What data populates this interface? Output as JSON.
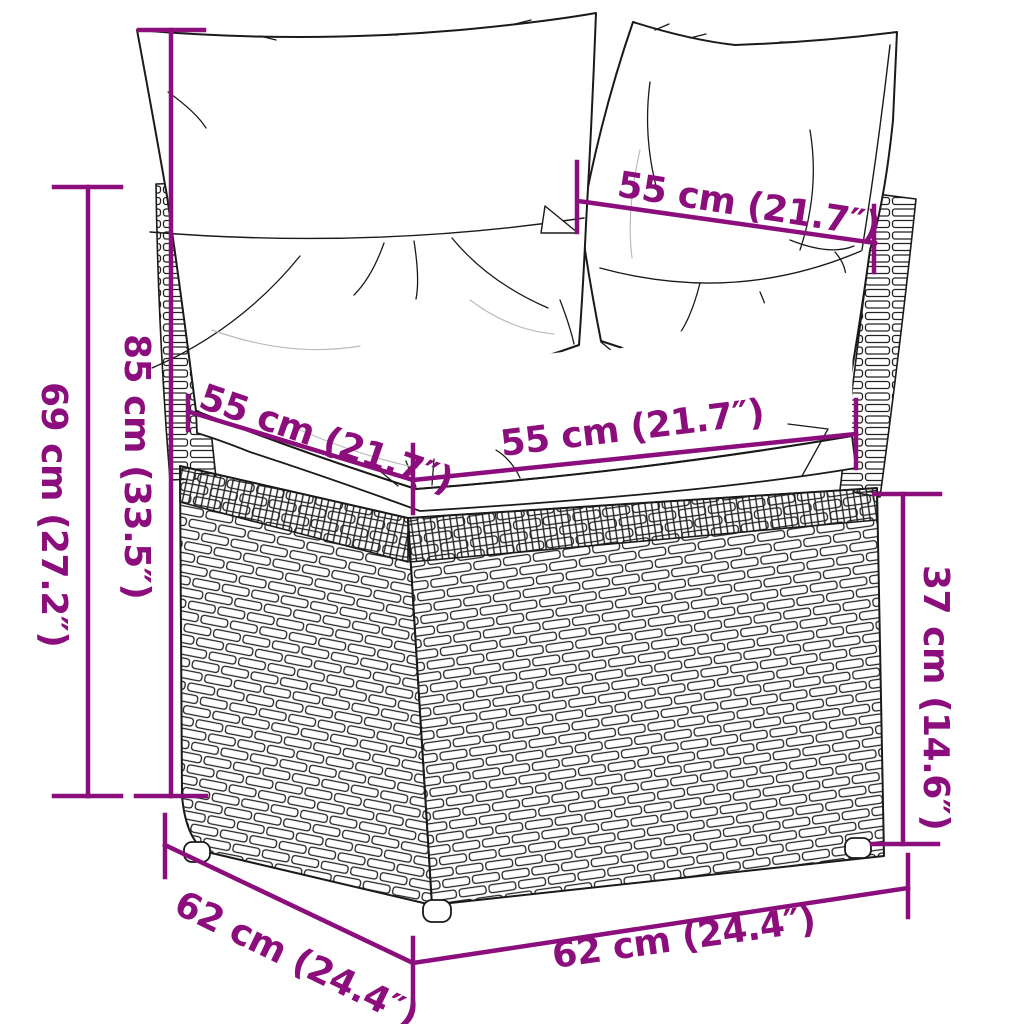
{
  "colors": {
    "accent": "#8C0E7C",
    "outline": "#1A1A1A"
  },
  "measurements": {
    "back_width": "55 cm (21.7″)",
    "cushion_height": "85 cm (33.5″)",
    "frame_height": "69 cm (27.2″)",
    "seat_depth": "55 cm (21.7″)",
    "seat_width": "55 cm (21.7″)",
    "seat_height": "37 cm (14.6″)",
    "base_depth": "62 cm (24.4″)",
    "base_width": "62 cm (24.4″)"
  }
}
